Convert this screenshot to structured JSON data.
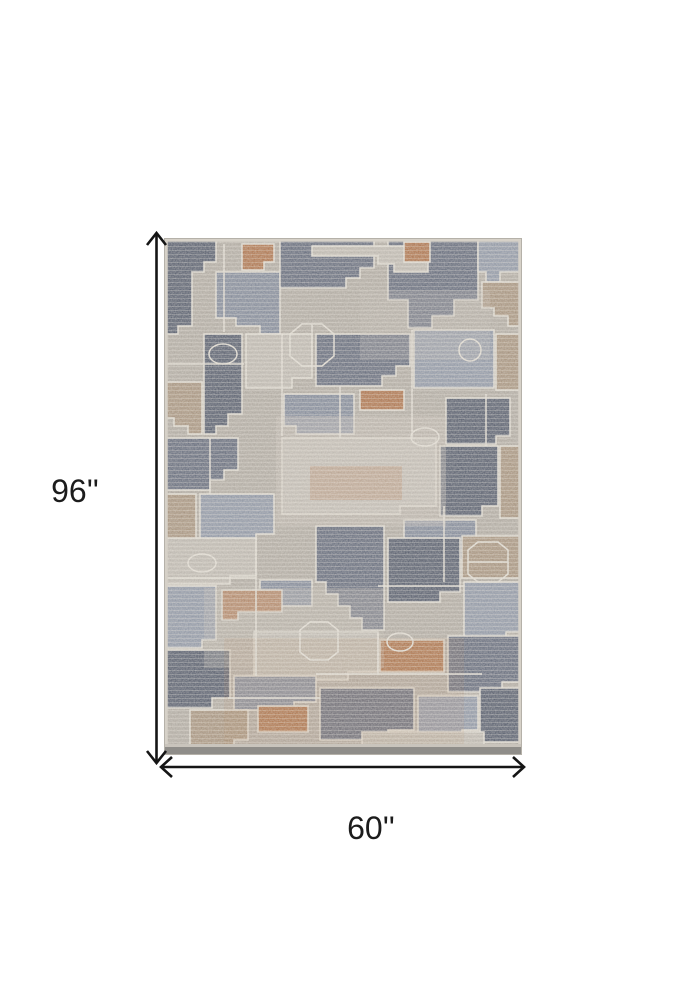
{
  "image": {
    "type": "product-dimension-diagram",
    "background": "#ffffff",
    "subject": "Abstract patchwork area rug, gray / slate blue / rust tones"
  },
  "rug": {
    "palette": {
      "base_taupe": "#b2aca3",
      "slate": "#5d6578",
      "slate_dark": "#4e5668",
      "slate_light": "#7e8799",
      "blue_gray": "#8d96a7",
      "gray_light": "#c1bcb3",
      "warm_tan": "#a7927b",
      "rust": "#ae6e43",
      "outline_cream": "#e6e1d7",
      "edge_gray": "#8f8d89",
      "border_pale": "#d6d1c8"
    }
  },
  "dimensions": {
    "height_label": "96''",
    "width_label": "60''",
    "arrow_color": "#151515",
    "label_color": "#1c1c1c"
  }
}
